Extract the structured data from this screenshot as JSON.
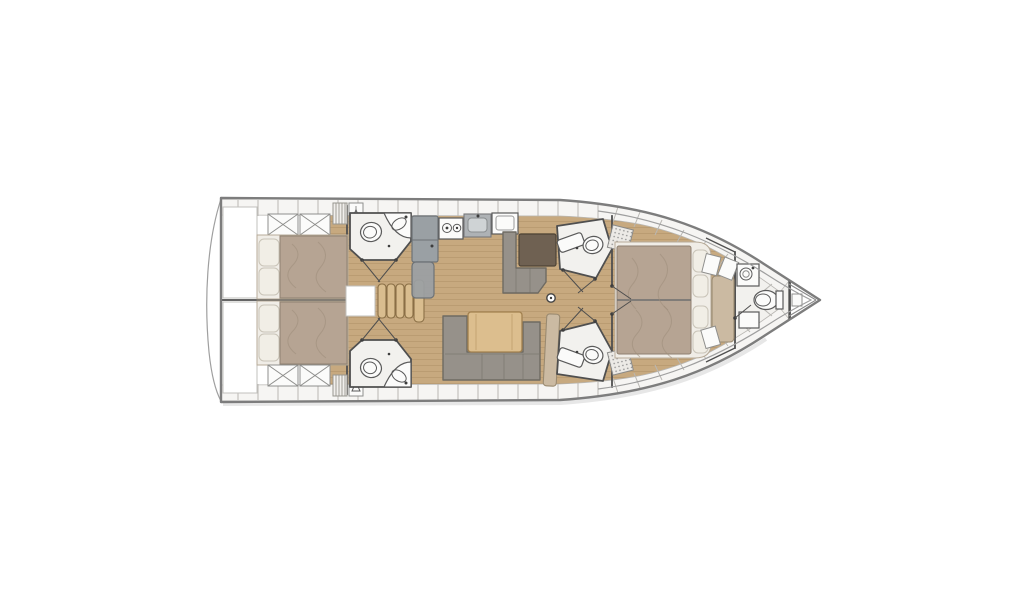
{
  "meta": {
    "title": "Sailing yacht interior deck plan",
    "type": "deck-plan",
    "orientation": "bow-right"
  },
  "colors": {
    "hull_outline": "#7d7d7d",
    "wall": "#4f4f4f",
    "locker_fill": "#f6f5f3",
    "locker_stroke": "#b9b7b3",
    "floor_wood": "#c7a97f",
    "floor_plank": "#a8885f",
    "mattress": "#b6a493",
    "mattress_stroke": "#8f8070",
    "pillow": "#f1eee6",
    "pillow_stroke": "#c9c4b8",
    "sofa": "#96918a",
    "sofa_dark": "#6e6a62",
    "table_wood": "#dcbe8e",
    "table_stroke": "#a2814f",
    "cabinet_gray": "#9aa0a4",
    "cabinet_stroke": "#6d7276",
    "dark_table": "#6f6152",
    "bench_tan": "#cbbaa2",
    "head_floor": "#f2f1ee",
    "fixture_stroke": "#5a5a5a",
    "steps_wood": "#d9bd8f"
  },
  "features": {
    "cabins": 3,
    "double_berths": 3,
    "toilets": 5,
    "showers": 2,
    "stove_burners": 2,
    "companionway_steps": 5,
    "saloon_layout": "U-shaped sofa with wood table",
    "bow_direction": "right"
  },
  "rooms": {
    "swim_platform": {
      "label": "Swim platform / transom"
    },
    "aft_cabin_port": {
      "label": "Aft cabin port with double berth"
    },
    "aft_cabin_starboard": {
      "label": "Aft cabin starboard with double berth"
    },
    "head_aft_port": {
      "label": "Aft port head with toilet and sink"
    },
    "head_aft_starboard": {
      "label": "Aft starboard head with toilet and sink"
    },
    "companionway": {
      "label": "Companionway steps"
    },
    "galley": {
      "label": "Galley with fridge, two-burner stove and sink"
    },
    "nav_station": {
      "label": "Navigation station with chart table and seat"
    },
    "saloon": {
      "label": "Saloon with U-shaped sofa and table"
    },
    "head_mid_port": {
      "label": "Mid port head with shower and toilet"
    },
    "head_mid_starboard": {
      "label": "Mid starboard head with shower and toilet"
    },
    "forward_cabin": {
      "label": "Forward cabin with island double berth"
    },
    "forward_head": {
      "label": "Forward en-suite head"
    },
    "anchor_locker": {
      "label": "Anchor locker at bow"
    },
    "mast": {
      "label": "Mast post"
    }
  }
}
